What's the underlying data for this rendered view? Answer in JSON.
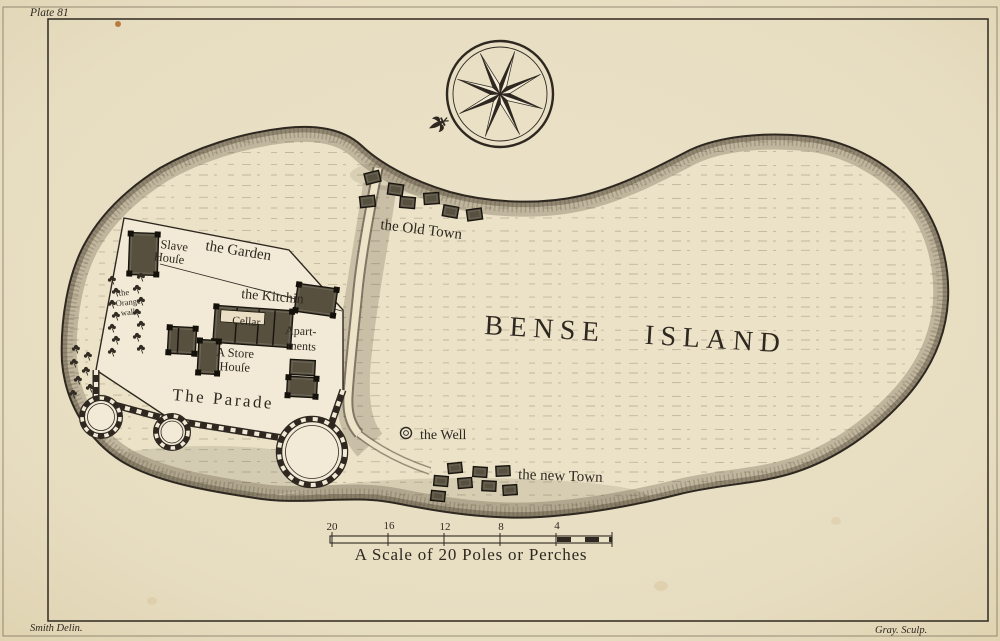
{
  "plate": {
    "number": "Plate 81",
    "drawn_by": "Smith Delin.",
    "engraved_by": "Gray. Sculp."
  },
  "map": {
    "title": "BENSE ISLAND",
    "labels": {
      "old_town": "the Old Town",
      "new_town": "the new Town",
      "well": "the Well",
      "garden": "the Garden",
      "slave_house": [
        "Slave",
        "Houſe"
      ],
      "kitchin": "the Kitchin",
      "cellar": "Cellar",
      "apartments": [
        "Apart-",
        "ments"
      ],
      "store_house": [
        "A Store",
        "Houſe"
      ],
      "parade": "The Parade",
      "orange_walk": [
        "the",
        "Orange",
        "walk"
      ]
    },
    "scale": {
      "caption": "A Scale of 20 Poles or Perches",
      "ticks": [
        "20",
        "16",
        "12",
        "8",
        "4"
      ],
      "unit": "Poles or Perches",
      "length": 20
    },
    "icons": {
      "compass_rose": "8-point-star",
      "fleur_de_lis": "stylized-lily-pointer",
      "well": "double-circle",
      "tree": "small-shrub-glyph",
      "building": "hatched-rectangle"
    },
    "colors": {
      "paper": "#e7ddc1",
      "island": "#ebe2c7",
      "fort": "#f2ead6",
      "ink": "#2e2820",
      "building": "#57503f",
      "building_dark": "#14100a",
      "shade": "#5f5440",
      "fox_spot": "#b06a28"
    }
  }
}
